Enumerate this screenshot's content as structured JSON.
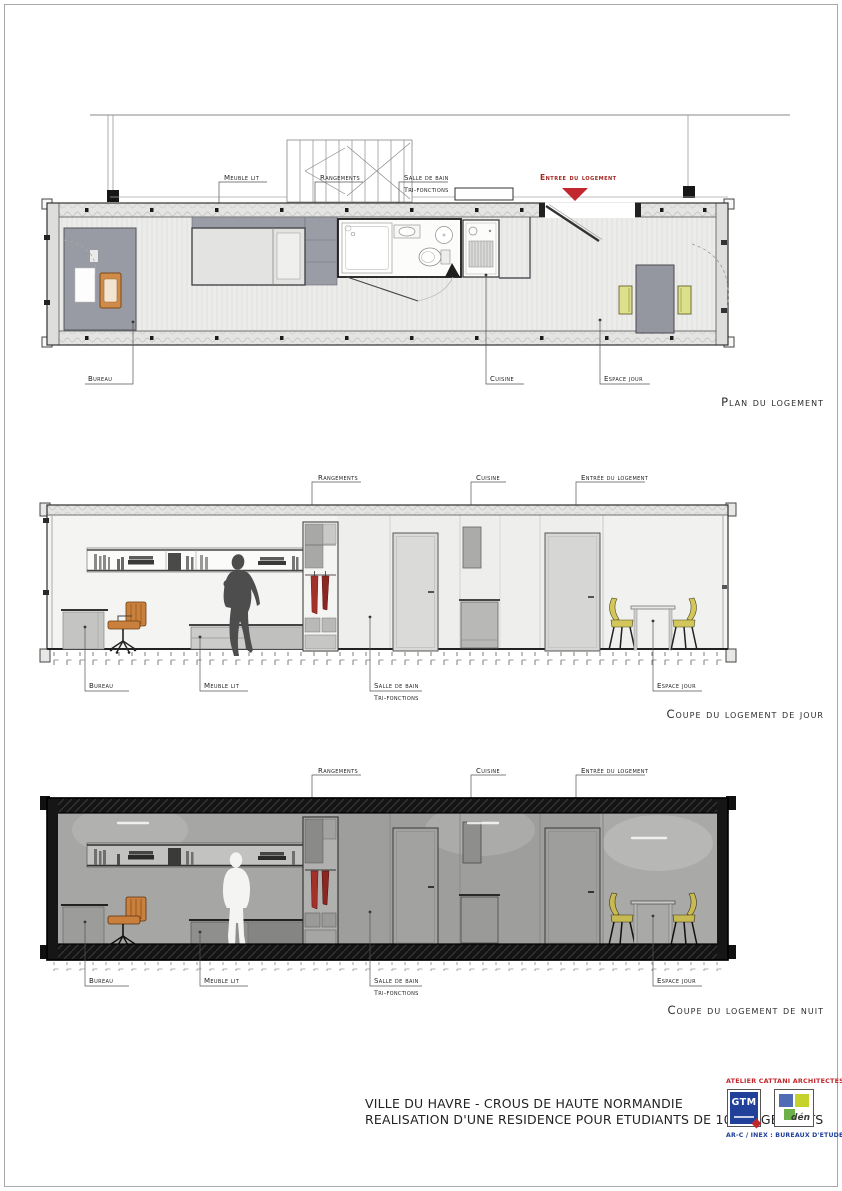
{
  "plan": {
    "title": "Plan du logement",
    "top_labels": {
      "meuble_lit": "Meuble lit",
      "rangements": "Rangements",
      "salle_de_bain": "Salle de bain",
      "tri_fonctions": "Tri-fonctions",
      "entree_du_logement": "Entree du logement"
    },
    "bottom_labels": {
      "bureau": "Bureau",
      "cuisine": "Cuisine",
      "espace_jour": "Espace jour"
    }
  },
  "coupe_jour": {
    "title": "Coupe du logement de jour",
    "top_labels": {
      "rangements": "Rangements",
      "cuisine": "Cuisine",
      "entree_du_logement": "Entrée du logement"
    },
    "bottom_labels": {
      "bureau": "Bureau",
      "meuble_lit": "Meuble lit",
      "salle_de_bain": "Salle de bain",
      "tri_fonctions": "Tri-fonctions",
      "espace_jour": "Espace jour"
    }
  },
  "coupe_nuit": {
    "title": "Coupe du logement de nuit",
    "top_labels": {
      "rangements": "Rangements",
      "cuisine": "Cuisine",
      "entree_du_logement": "Entrée du logement"
    },
    "bottom_labels": {
      "bureau": "Bureau",
      "meuble_lit": "Meuble lit",
      "salle_de_bain": "Salle de bain",
      "tri_fonctions": "Tri-fonctions",
      "espace_jour": "Espace jour"
    }
  },
  "title_block": {
    "project_line1": "VILLE DU HAVRE - CROUS DE HAUTE NORMANDIE",
    "project_line2": "REALISATION D'UNE RESIDENCE POUR ETUDIANTS DE 100 LOGEMENTS",
    "architect": "ATELIER CATTANI ARCHITECTES",
    "logo_gtm_text": "GTM",
    "logo_den_text": "dén",
    "engineers": "AR-C / INEX : BUREAUX D'ETUDES"
  },
  "colors": {
    "entrance_red": "#c1272d",
    "architect_red": "#c1272d",
    "brand_blue": "#20409a",
    "logo_green": "#6db04a",
    "logo_yellow_green": "#c5d22b",
    "chair_orange": "#c9803c",
    "chair_yellow": "#d3c75c",
    "clothes_red": "#a3312a"
  }
}
